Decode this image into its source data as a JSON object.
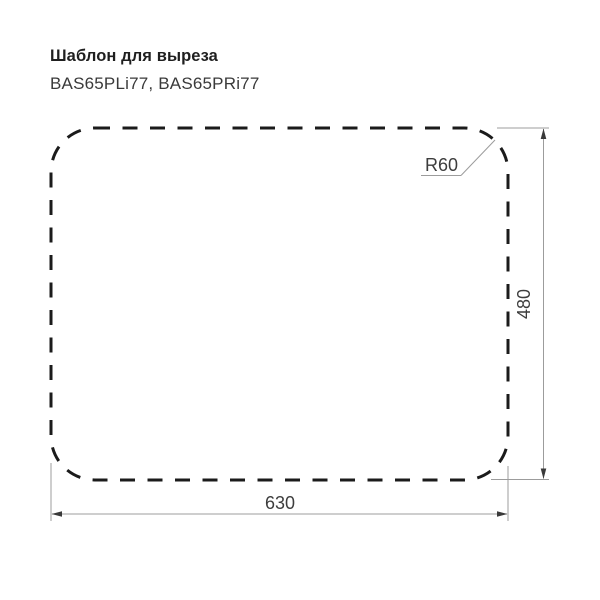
{
  "header": {
    "title": "Шаблон для выреза",
    "models": "BAS65PLi77, BAS65PRi77"
  },
  "diagram": {
    "type": "sink-cutout-template-drawing",
    "dimensions": {
      "width_mm": 630,
      "height_mm": 480,
      "corner_radius_mm": 60
    },
    "labels": {
      "width": "630",
      "height": "480",
      "corner_radius": "R60"
    },
    "colors": {
      "cutout_outline": "#1b1b1b",
      "dimension_lines": "#9c9c9c",
      "dimension_text": "#3d3d3d",
      "background": "#ffffff"
    }
  }
}
